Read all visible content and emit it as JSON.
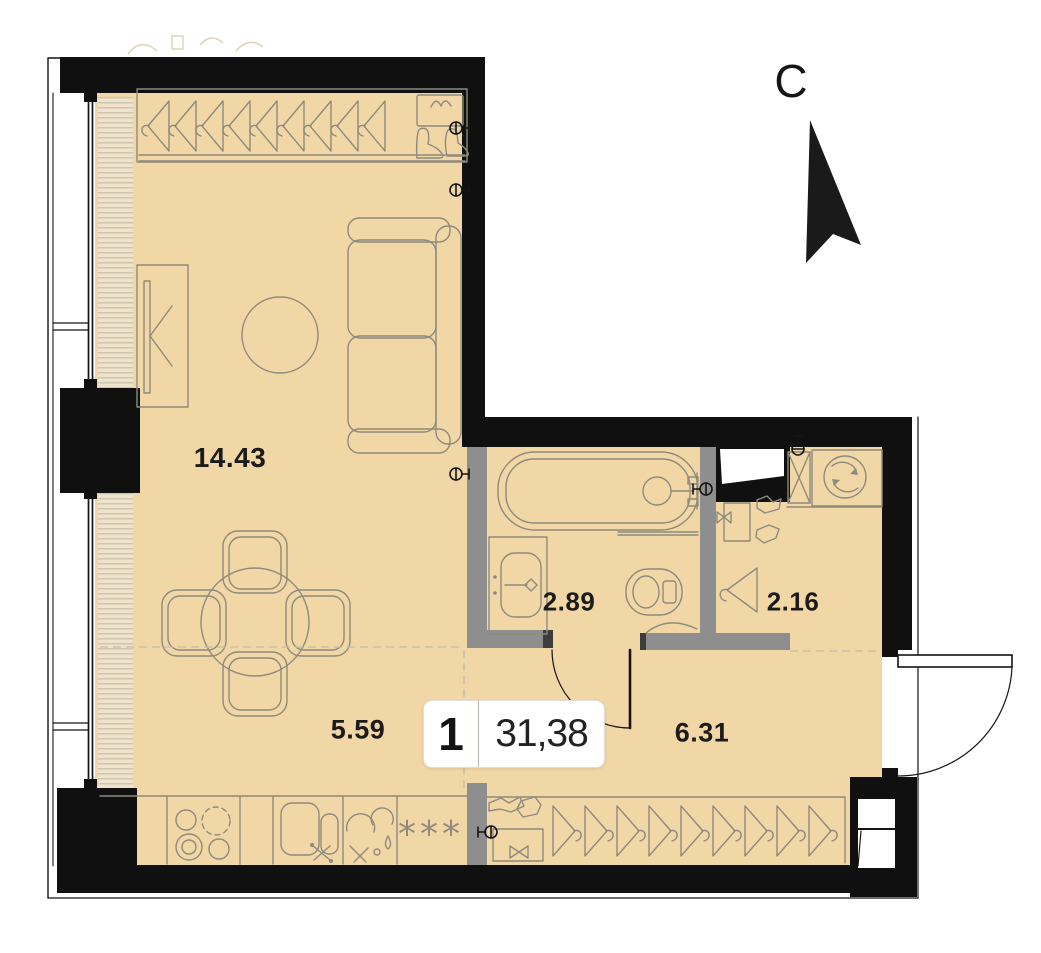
{
  "plan": {
    "compass": "C",
    "unit_number": "1",
    "total_area": "31,38",
    "areas": {
      "living": "14.43",
      "kitchen_dining": "5.59",
      "bathroom": "2.89",
      "storage": "2.16",
      "hallway": "6.31"
    },
    "freezer_symbol": "***",
    "colors": {
      "floor": "#f2d7a6",
      "wall": "#101010",
      "partition": "#8e8e8e",
      "furniture_line": "#8e8a7d",
      "label_text": "#1b1b1b"
    }
  }
}
